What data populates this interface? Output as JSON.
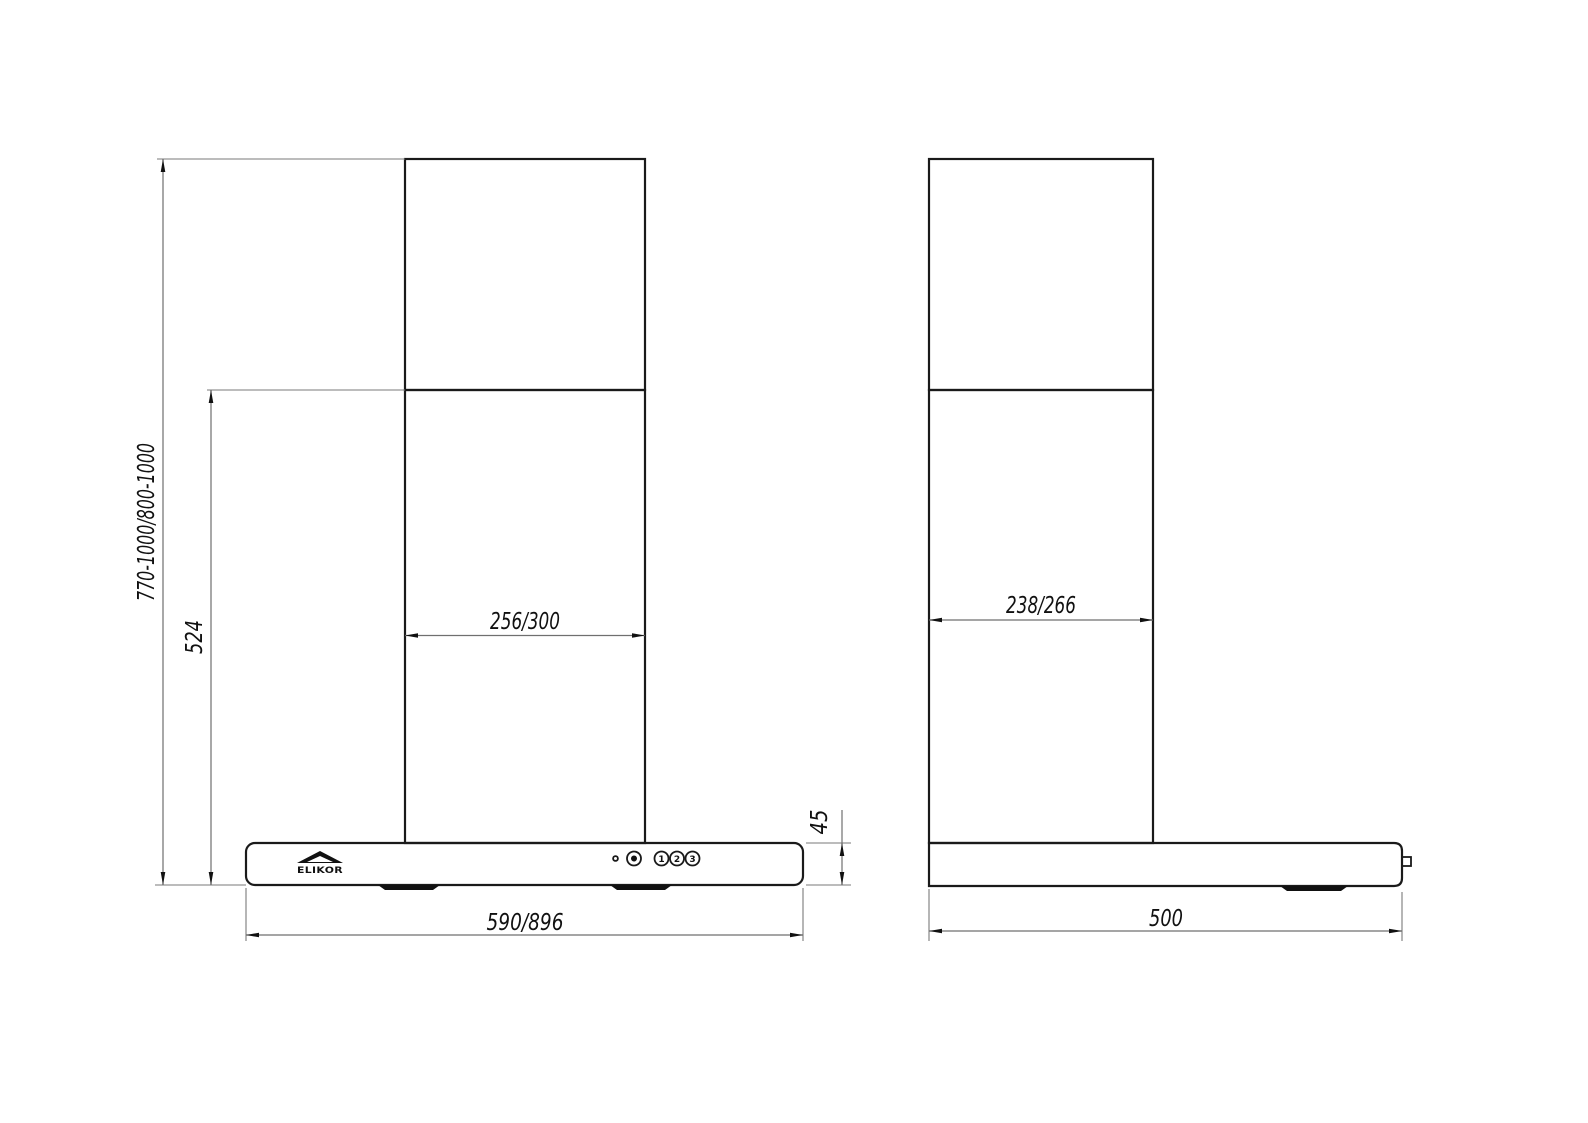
{
  "drawing": {
    "brand": "ELIKOR",
    "front_view": {
      "dim_total_height": "770-1000/800-1000",
      "dim_chimney_height": "524",
      "dim_chimney_width": "256/300",
      "dim_body_width": "590/896",
      "dim_body_height": "45"
    },
    "side_view": {
      "dim_chimney_depth": "238/266",
      "dim_body_depth": "500"
    },
    "controls": {
      "speed1": "1",
      "speed2": "2",
      "speed3": "3"
    }
  }
}
